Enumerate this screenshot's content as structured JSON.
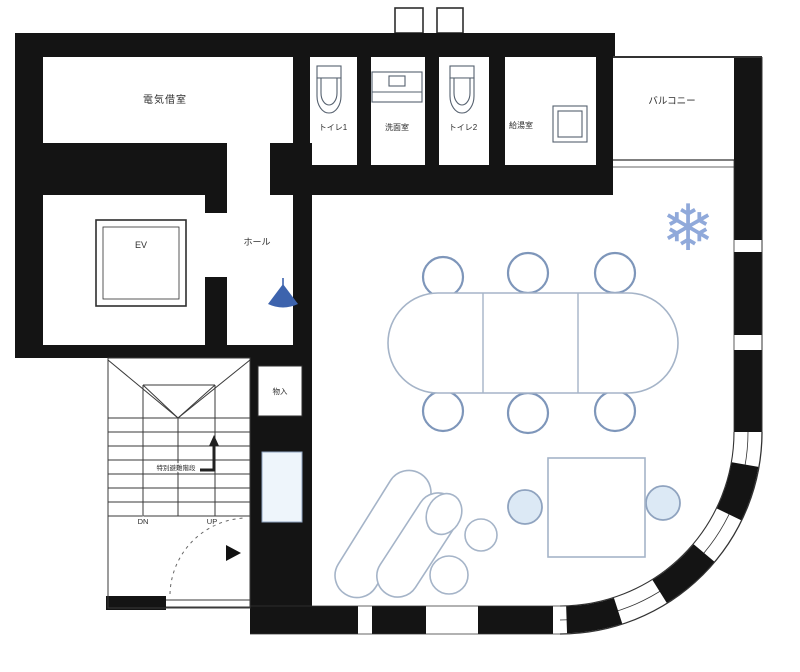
{
  "plan": {
    "kind": "building-floor-plan",
    "rooms": {
      "electrical_room": "電気借室",
      "toilet_1": "トイレ1",
      "washroom": "洗面室",
      "toilet_2": "トイレ2",
      "kitchenette": "給湯室",
      "balcony": "バルコニー",
      "elevator": "EV",
      "hall": "ホール",
      "storage": "物入"
    },
    "stairs": {
      "note": "特別避難階段",
      "down_label": "DN",
      "up_label": "UP"
    },
    "icons": {
      "snowflake_glyph": "❄",
      "snowflake": "snowflake-ornament",
      "pendant": "pendant-light",
      "entry_arrow": "entry-direction-arrow"
    },
    "colors": {
      "wall": "#141414",
      "furniture_stroke": "#a5b4c8",
      "chair_stroke": "#7e96ba",
      "chair_fill": "#dce9f5",
      "pendant_blue": "#3d63ad",
      "snowflake_blue": "#7d9bd4",
      "niche_fill": "#eef5fb"
    },
    "furniture": {
      "conference_table_sections": 3,
      "conference_chairs": 6,
      "lounge_sofas": 2,
      "lounge_round_tables": 2,
      "square_table_chairs": 2
    }
  }
}
